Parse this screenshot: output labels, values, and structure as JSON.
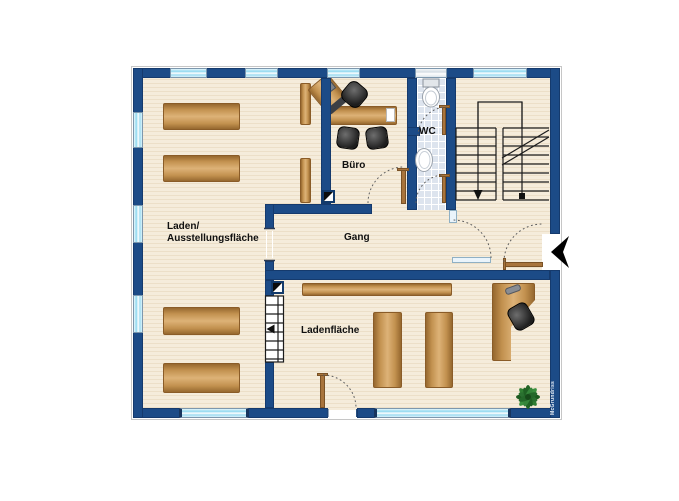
{
  "watermark": {
    "text": "McGrundriss"
  },
  "rooms": {
    "laden": {
      "label_line1": "Laden/",
      "label_line2": "Ausstellungsfläche"
    },
    "buero": {
      "label": "Büro"
    },
    "wc": {
      "label": "WC"
    },
    "gang": {
      "label": "Gang"
    },
    "ladenflaeche": {
      "label": "Ladenfläche"
    }
  },
  "colors": {
    "wall_blue": "#1c4b87",
    "floor_cream": "#f3e9d8",
    "wood_brown": "#c2914f",
    "window_glass": "#9fdcf1",
    "wc_tile": "#dde4ee",
    "plant_green": "#2f7d32",
    "entrance_arrow": "#000000",
    "label_text": "#101010"
  },
  "icons": {
    "entrance_arrow": "◀",
    "chimney_symbol": "◩",
    "plant": "✽",
    "toilet": "⬯",
    "sink": "⬯",
    "stairs": "≡"
  }
}
